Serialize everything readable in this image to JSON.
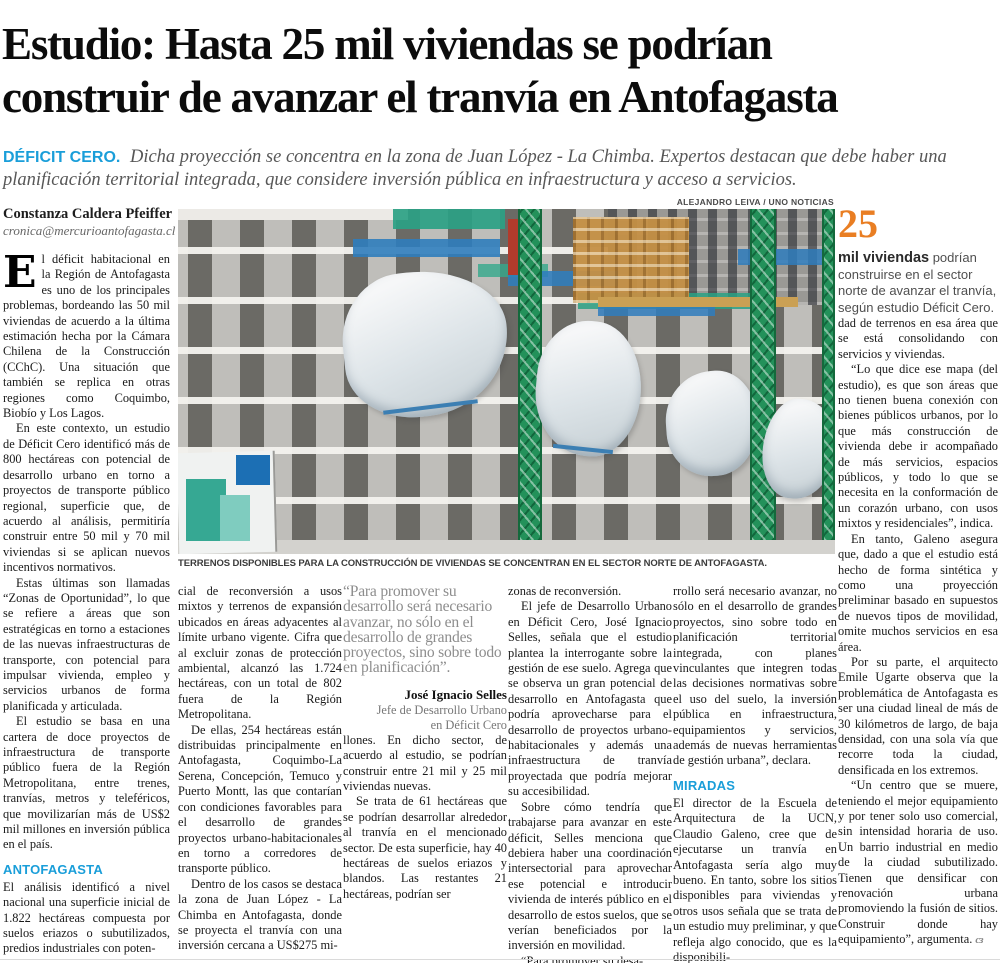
{
  "colors": {
    "accent_cyan": "#1A9ED9",
    "accent_orange": "#E97E23",
    "quote_gray": "#8d8d8d"
  },
  "headline": {
    "line1": "Estudio: Hasta 25 mil viviendas se podrían",
    "line2": "construir de avanzar el tranvía en Antofagasta"
  },
  "kicker": {
    "label": "DÉFICIT CERO.",
    "text": "Dicha proyección se concentra en la zona de Juan López - La Chimba. Expertos destacan que debe haber una planificación territorial integrada, que considere inversión pública en infraestructura y acceso a servicios."
  },
  "byline": {
    "author": "Constanza Caldera Pfeiffer",
    "email": "cronica@mercurioantofagasta.cl"
  },
  "photo": {
    "credit": "ALEJANDRO LEIVA / UNO NOTICIAS",
    "caption": "TERRENOS DISPONIBLES PARA LA CONSTRUCCIÓN DE VIVIENDAS SE CONCENTRAN EN EL SECTOR NORTE DE ANTOFAGASTA."
  },
  "col1": {
    "dropcap": "E",
    "p1": "l déficit habitacional en la Región de Antofagasta es uno de los principales problemas, bordeando las 50 mil viviendas de acuerdo a la última estimación hecha por la Cámara Chilena de la Construcción (CChC). Una situación que también se replica en otras regiones como Coquimbo, Biobío y Los Lagos.",
    "p2": "En este contexto, un estudio de Déficit Cero identificó más de 800 hectáreas con potencial de desarrollo urbano en torno a proyectos de transporte público regional, superficie que, de acuerdo al análisis, permitiría construir entre 50 mil y 70 mil viviendas si se aplican nuevos incentivos normativos.",
    "p3": "Estas últimas son llamadas “Zonas de Oportunidad”, lo que se refiere a áreas que son estratégicas en torno a estaciones de las nuevas infraestructuras de transporte, con potencial para impulsar vivienda, empleo y servicios urbanos de forma planificada y articulada.",
    "p4": "El estudio se basa en una cartera de doce proyectos de infraestructura de transporte público fuera de la Región Metropolitana, entre trenes, tranvías, metros y teleféricos, que movilizarían más de US$2 mil millones en inversión pública en el país.",
    "header": "ANTOFAGASTA",
    "p5": "El análisis identificó a nivel nacional una superficie inicial de 1.822 hectáreas compuesta por suelos eriazos o subutilizados, predios industriales con poten-"
  },
  "col2": {
    "p1": "cial de reconversión a usos mixtos y terrenos de expansión ubicados en áreas adyacentes al límite urbano vigente. Cifra que al excluir zonas de protección ambiental, alcanzó las 1.724 hectáreas, con un total de 802 fuera de la Región Metropolitana.",
    "p2": "De ellas, 254 hectáreas están distribuidas principalmente en Antofagasta, Coquimbo-La Serena, Concepción, Temuco y Puerto Montt, las que contarían con condiciones favorables para el desarrollo de grandes proyectos urbano-habitacionales en torno a corredores de transporte público.",
    "p3": "Dentro de los casos se destaca la zona de Juan López - La Chimba en Antofagasta, donde se proyecta el tranvía con una inversión cercana a US$275 mi-"
  },
  "quote": {
    "text": "“Para promover su desarrollo será necesario avanzar, no sólo en el desarrollo de grandes proyectos, sino sobre todo en planificación”.",
    "name": "José Ignacio Selles",
    "role1": "Jefe de Desarrollo Urbano",
    "role2": "en Déficit Cero"
  },
  "col3": {
    "p1": "llones. En dicho sector, de acuerdo al estudio, se podrían construir entre 21 mil y 25 mil viviendas nuevas.",
    "p2": "Se trata de 61 hectáreas que se podrían desarrollar alrededor al tranvía en el mencionado sector. De esta superficie, hay 40 hectáreas de suelos eriazos y blandos. Las restantes 21 hectáreas, podrían ser"
  },
  "col4": {
    "p1": "zonas de reconversión.",
    "p2": "El jefe de Desarrollo Urbano en Déficit Cero, José Ignacio Selles, señala que el estudio plantea la interrogante sobre la gestión de ese suelo. Agrega que se observa un gran potencial de desarrollo en Antofagasta que podría aprovecharse para el desarrollo de proyectos urbano-habitacionales y además una infraestructura de tranvía proyectada que podría mejorar su accesibilidad.",
    "p3": "Sobre cómo tendría que trabajarse para avanzar en este déficit, Selles menciona que debiera haber una coordinación intersectorial para aprovechar ese potencial e introducir vivienda de interés público en el desarrollo de estos suelos, que se verían beneficiados por la inversión en movilidad.",
    "p4": "“Para promover su desa-"
  },
  "col5": {
    "p1": "rrollo será necesario avanzar, no sólo en el desarrollo de grandes proyectos, sino sobre todo en planificación territorial integrada, con planes vinculantes que integren todas las decisiones normativas sobre el uso del suelo, la inversión pública en infraestructura, equipamientos y servicios, además de nuevas herramientas de gestión urbana”, declara.",
    "header": "MIRADAS",
    "p2": "El director de la Escuela de Arquitectura de la UCN, Claudio Galeno, cree que de ejecutarse un tranvía en Antofagasta sería algo muy bueno. En tanto, sobre los sitios disponibles para viviendas y otros usos señala que se trata de un estudio muy preliminar, y que refleja algo conocido, que es la disponibili-"
  },
  "factbox": {
    "number": "25",
    "bold": "mil viviendas",
    "text": "podrían construirse en el sector norte de avanzar el tranvía, según estudio Déficit Cero."
  },
  "col6": {
    "p1": "dad de terrenos en esa área que se está consolidando con servicios y viviendas.",
    "p2": "“Lo que dice ese mapa (del estudio), es que son áreas que no tienen buena conexión con bienes públicos urbanos, por lo que más construcción de vivienda debe ir acompañado de más servicios, espacios públicos, y todo lo que se necesita en la conformación de un corazón urbano, con usos mixtos y residenciales”, indica.",
    "p3": "En tanto, Galeno asegura que, dado a que el estudio está hecho de forma sintética y como una proyección preliminar basado en supuestos de nuevos tipos de movilidad, omite muchos servicios en esa área.",
    "p4": "Por su parte, el arquitecto Emile Ugarte observa que la problemática de Antofagasta es ser una ciudad lineal de más de 30 kilómetros de largo, de baja densidad, con una sola vía que recorre toda la ciudad, densificada en los extremos.",
    "p5": "“Un centro que se muere, teniendo el mejor equipamiento y por tener solo uso comercial, sin intensidad horaria de uso. Un barrio industrial en medio de la ciudad subutilizado. Tienen que densificar con renovación urbana promoviendo la fusión de sitios. Construir donde hay equipamiento”, argumenta."
  },
  "endmark": "cз"
}
